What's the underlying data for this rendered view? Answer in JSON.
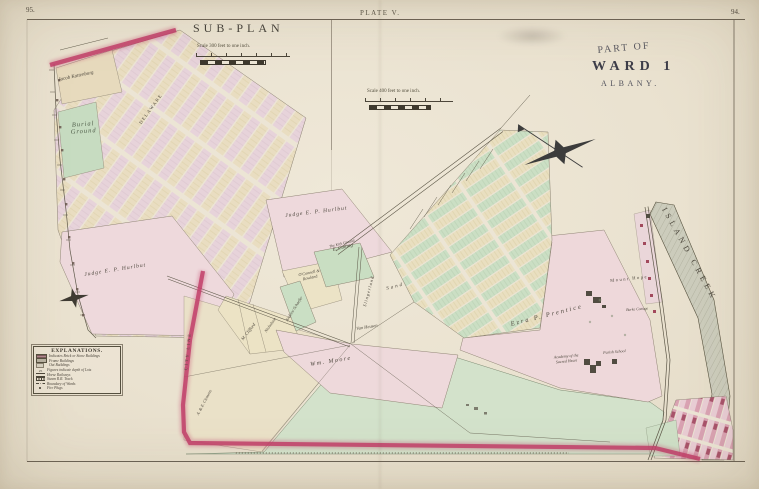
{
  "page": {
    "left_number": "95.",
    "right_number": "94.",
    "plate_label": "PLATE V."
  },
  "subplan": {
    "title": "SUB-PLAN",
    "scale_text": "Scale 300 feet to one inch.",
    "labels": {
      "jacob": "Jacob Kattenburg",
      "burial": "Burial Ground",
      "delaware": "DELAWARE",
      "hurlbut": "Judge E. P. Hurlbut"
    }
  },
  "legend": {
    "title": "EXPLANATIONS.",
    "items": [
      {
        "swatch": "brick",
        "text": "Indicates Brick or Stone Buildings"
      },
      {
        "swatch": "frame",
        "text": "Frame Buildings"
      },
      {
        "swatch": "out",
        "text": "Out Buildings"
      },
      {
        "swatch": "figures",
        "text": "Figures indicate depth of Lots"
      },
      {
        "swatch": "horse-railway",
        "text": "Horse Railways"
      },
      {
        "swatch": "steam-rr",
        "text": "Steam R.R. Track"
      },
      {
        "swatch": "ward-boundary",
        "text": "Boundary of Wards"
      },
      {
        "swatch": "fire-plug",
        "text": "Fire Plugs"
      }
    ]
  },
  "main": {
    "title": {
      "line1": "PART OF",
      "line2": "WARD 1",
      "line3": "ALBANY."
    },
    "scale_text": "Scale 400 feet to one inch.",
    "labels": {
      "hurlbut": "Judge E. P. Hurlbut",
      "kirk_ground": "The Kirk Ground",
      "cutting": "E. Cutting",
      "oconnell": "O'Connell & Rowland",
      "schaefer": "Andrew Schaefer",
      "slingerland": "Slingerland",
      "sand": "Sand",
      "nicholson": "Nicholson",
      "clifford": "M. Clifford",
      "van_heusen": "Van Heusen",
      "moore": "Wm. Moore",
      "prentice": "Ezra P. Prentice",
      "mount_hope": "Mount Hope",
      "burke_cottage": "Burke Cottage",
      "academy": "Academy of the Sacred Heart",
      "parish_school": "Parish School",
      "island_creek": "ISLAND CREEK",
      "city_line": "CITY LINE",
      "clemens": "A. & E. Clemens"
    },
    "colors": {
      "city_line_red": "#c23f6a",
      "parcel_pink": "#eed9db",
      "parcel_green": "#cbdfc4",
      "parcel_cream": "#e9dfc0",
      "paper": "#ece5d5"
    }
  }
}
